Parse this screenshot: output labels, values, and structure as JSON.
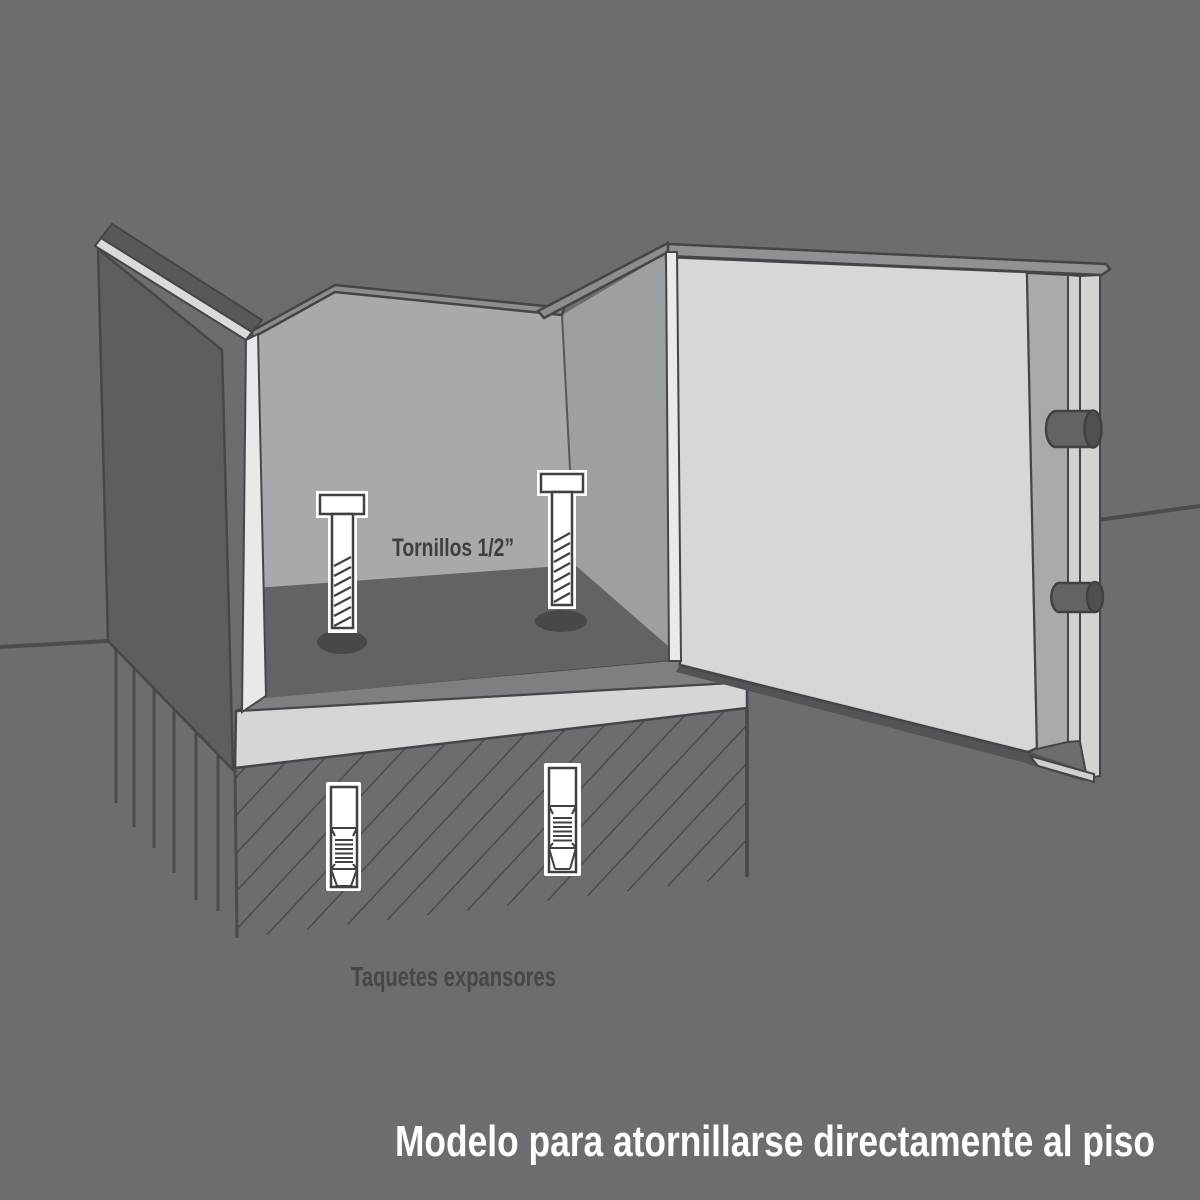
{
  "diagram": {
    "title": "Modelo para atornillarse directamente al piso",
    "labels": {
      "bolts": "Tornillos 1/2”",
      "anchors": "Taquetes expansores"
    },
    "colors": {
      "background": "#6c6d70",
      "outline": "#434548",
      "safe_outer_wall": "#5c5e61",
      "interior_wall_left": "#a7a9ac",
      "interior_wall_right": "#9da0a3",
      "interior_floor": "#616366",
      "floor_hole": "#46484b",
      "base_shell": "#d5d6d5",
      "door_face": "#d6d7d6",
      "door_edge_band": "#8b8d90",
      "hardware_white": "#ffffff",
      "lock_bolt_gray": "#626367",
      "hatch_line": "#4a4b4e",
      "label_text": "#45474a",
      "caption_text": "#ffffff"
    }
  }
}
